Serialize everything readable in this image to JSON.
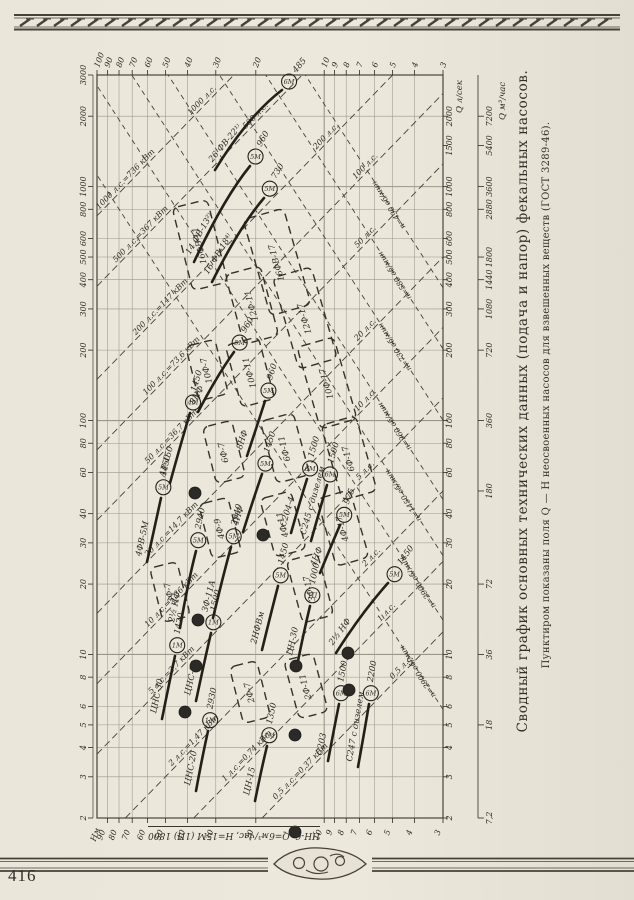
{
  "page": {
    "number": "416"
  },
  "caption": {
    "title": "Сводный график основных технических данных (подача и напор) фекальных насосов.",
    "subtitle": "Пунктиром показаны поля Q — Н неосвоенных насосов для взвешенных веществ (ГОСТ 3289-46)."
  },
  "annotation": {
    "full": "ЦН-6, Q=6м³/час, Н=15М (1П) 1800",
    "pump": "ЦН-6",
    "q": "6 м³/час",
    "h": "15 м",
    "motor": "1П",
    "rpm": "1800"
  },
  "chart_data": {
    "type": "line",
    "orientation": "chart is printed rotated 90° (rotate page clockwise to read); Q horizontal log axis, H vertical log axis",
    "grid": "log-log",
    "h_axis": {
      "label": "Нм",
      "unit": "м",
      "range": [
        3,
        100
      ],
      "ticks": [
        100,
        90,
        80,
        70,
        60,
        50,
        40,
        30,
        20,
        10,
        9,
        8,
        7,
        6,
        5,
        4,
        3
      ]
    },
    "q_axis_lsec": {
      "label": "Q л/сек",
      "range": [
        2,
        3000
      ],
      "ticks_left": [
        3000,
        2000,
        1000,
        800,
        600,
        500,
        400,
        300,
        200,
        100,
        80,
        60,
        40,
        30,
        20,
        10,
        8,
        6,
        5,
        4,
        3,
        2
      ],
      "ticks_right": [
        2000,
        1500,
        1000,
        800,
        600,
        500,
        400,
        300,
        200,
        100,
        80,
        60,
        40,
        30,
        20,
        10,
        8,
        6,
        5,
        4,
        3,
        2
      ]
    },
    "q_axis_m3h": {
      "label": "Q м³/час",
      "ticks": [
        {
          "t": "7200",
          "q": 2000
        },
        {
          "t": "5400",
          "q": 1500
        },
        {
          "t": "3600",
          "q": 1000
        },
        {
          "t": "2880",
          "q": 800
        },
        {
          "t": "1800",
          "q": 500
        },
        {
          "t": "1440",
          "q": 400
        },
        {
          "t": "1080",
          "q": 300
        },
        {
          "t": "720",
          "q": 200
        },
        {
          "t": "360",
          "q": 100
        },
        {
          "t": "180",
          "q": 50
        },
        {
          "t": "72",
          "q": 20
        },
        {
          "t": "36",
          "q": 10
        },
        {
          "t": "18",
          "q": 5
        },
        {
          "t": "7,2",
          "q": 2
        }
      ]
    },
    "power_lines": [
      {
        "hp": 1000,
        "full": "1000 л.с.=736 кВт",
        "short": "1000 л.с."
      },
      {
        "hp": 500,
        "full": "500 л.с.=367 кВт",
        "short": "500 л.с."
      },
      {
        "hp": 200,
        "full": "200 л.с.=147 кВт",
        "short": "200 л.с."
      },
      {
        "hp": 100,
        "full": "100 л.с.=73,6 кВт",
        "short": "100 л.с."
      },
      {
        "hp": 50,
        "full": "50 л.с.=36,7 кВт",
        "short": "50 л.с."
      },
      {
        "hp": 20,
        "full": "20 л.с.=14,7 кВт",
        "short": "20 л.с."
      },
      {
        "hp": 10,
        "full": "10 л.с.=7,36 кВт",
        "short": "10 л.с."
      },
      {
        "hp": 5,
        "full": "5 л.с.=3,7 кВт",
        "short": "5 л.с."
      },
      {
        "hp": 2,
        "full": "2 л.с.=1,47 кВт",
        "short": "2 л.с."
      },
      {
        "hp": 1,
        "full": "1 л.с.=0,74 кВт",
        "short": "1 л.с."
      },
      {
        "hp": 0.5,
        "full": "0,5 л.с.=0,37 кВт",
        "short": "0,5 л.с."
      }
    ],
    "speed_lines": [
      {
        "label": "n=490 об/мин",
        "q": 820,
        "h": 5.1
      },
      {
        "label": "n=580 об/мин",
        "q": 410,
        "h": 4.8
      },
      {
        "label": "n=730 об/мин",
        "q": 203,
        "h": 4.8
      },
      {
        "label": "n=960 об/мин",
        "q": 93,
        "h": 4.8
      },
      {
        "label": "n=1450 об/мин",
        "q": 47,
        "h": 4.4
      },
      {
        "label": "n=2900 об/мин",
        "q": 20,
        "h": 3.8
      },
      {
        "label": "n=2900 об/мин",
        "q": 8.3,
        "h": 3.8
      }
    ],
    "pump_curves": [
      {
        "label": "26 ФВ-22¹⁾",
        "motor": "6М",
        "rpm": "485",
        "pts": [
          [
            215,
            170
          ],
          [
            248,
            116
          ],
          [
            282,
            90
          ]
        ]
      },
      {
        "label": "14 ФВ-13²⁾",
        "motor": "5М",
        "rpm": "960",
        "pts": [
          [
            194,
            262
          ],
          [
            224,
            198
          ],
          [
            250,
            166
          ]
        ]
      },
      {
        "label": "16 ФВ-18⁴⁾",
        "motor": "5М",
        "rpm": "730",
        "pts": [
          [
            212,
            282
          ],
          [
            240,
            226
          ],
          [
            264,
            198
          ]
        ]
      },
      {
        "label": "8НФ",
        "motor": "5М",
        "rpm": "960",
        "pts": [
          [
            198,
            412
          ],
          [
            218,
            374
          ],
          [
            234,
            352
          ]
        ]
      },
      {
        "label": "8НФ",
        "motor": "5М",
        "rpm": "960",
        "pts": [
          [
            247,
            456
          ],
          [
            257,
            426
          ],
          [
            265,
            401
          ]
        ]
      },
      {
        "label": "АР-150",
        "motor": "4М",
        "rpm": "1450",
        "pts": [
          [
            170,
            483
          ],
          [
            181,
            443
          ],
          [
            190,
            413
          ]
        ]
      },
      {
        "label": "4ФВ-5М",
        "motor": "5М",
        "rpm": "1450",
        "pts": [
          [
            147,
            562
          ],
          [
            155,
            526
          ],
          [
            161,
            498
          ]
        ]
      },
      {
        "label": "2½ НФ",
        "motor": "5М",
        "rpm": "2940",
        "pts": [
          [
            180,
            628
          ],
          [
            188,
            582
          ],
          [
            196,
            551
          ]
        ]
      },
      {
        "label": "ЗФ-11А",
        "motor": "5М",
        "rpm": "2940",
        "pts": [
          [
            213,
            618
          ],
          [
            223,
            576
          ],
          [
            231,
            547
          ]
        ]
      },
      {
        "label": "4НФ",
        "motor": "5М",
        "rpm": "1450",
        "pts": [
          [
            243,
            532
          ],
          [
            254,
            497
          ],
          [
            262,
            474
          ]
        ]
      },
      {
        "label": "4НФ",
        "motor": "5М",
        "rpm": "975",
        "pts": [
          [
            320,
            573
          ],
          [
            331,
            546
          ],
          [
            340,
            525
          ]
        ]
      },
      {
        "label": "2НФВм",
        "motor": "5М",
        "rpm": "1450",
        "pts": [
          [
            262,
            650
          ],
          [
            271,
            613
          ],
          [
            278,
            586
          ]
        ]
      },
      {
        "label": "2½ НФ",
        "motor": "5М",
        "rpm": "1450",
        "pts": [
          [
            336,
            653
          ],
          [
            362,
            612
          ],
          [
            388,
            583
          ]
        ]
      },
      {
        "label": "С204-4",
        "motor": "6М",
        "rpm": "1500",
        "pts": [
          [
            291,
            533
          ],
          [
            300,
            501
          ],
          [
            307,
            479
          ]
        ]
      },
      {
        "label": "С245 с дизелем",
        "motor": "6М",
        "rpm": "1500",
        "pts": [
          [
            311,
            541
          ],
          [
            320,
            509
          ],
          [
            327,
            485
          ]
        ]
      },
      {
        "label": "ЦНС-50",
        "motor": "1М",
        "rpm": "1500",
        "pts": [
          [
            196,
            701
          ],
          [
            204,
            663
          ],
          [
            211,
            633
          ]
        ]
      },
      {
        "label": "ЦНС-30",
        "motor": "1М",
        "rpm": "1420",
        "pts": [
          [
            162,
            719
          ],
          [
            169,
            684
          ],
          [
            175,
            656
          ]
        ]
      },
      {
        "label": "ЦНС-20",
        "motor": "1М",
        "rpm": "2930",
        "pts": [
          [
            196,
            791
          ],
          [
            202,
            758
          ],
          [
            208,
            731
          ]
        ]
      },
      {
        "label": "ЦН-15",
        "motor": "1М",
        "rpm": "1350",
        "pts": [
          [
            255,
            801
          ],
          [
            261,
            771
          ],
          [
            267,
            746
          ]
        ]
      },
      {
        "label": "ЦН-30",
        "motor": "1П",
        "rpm": "1000",
        "pts": [
          [
            298,
            661
          ],
          [
            304,
            631
          ],
          [
            310,
            606
          ]
        ]
      },
      {
        "label": "С203",
        "motor": "6М",
        "rpm": "1500",
        "pts": [
          [
            328,
            761
          ],
          [
            334,
            729
          ],
          [
            339,
            704
          ]
        ]
      },
      {
        "label": "С247 с дизелем",
        "motor": "6М",
        "rpm": "2200",
        "pts": [
          [
            358,
            767
          ],
          [
            364,
            734
          ],
          [
            369,
            704
          ]
        ]
      }
    ],
    "pump_fields": [
      {
        "label": "16ФВ-11",
        "cx": 200,
        "cy": 245,
        "w": 36,
        "h": 85,
        "rot": -14
      },
      {
        "label": "16ФВ-17",
        "cx": 277,
        "cy": 262,
        "w": 42,
        "h": 100,
        "rot": -16
      },
      {
        "label": "12Ф-11",
        "cx": 252,
        "cy": 305,
        "w": 36,
        "h": 72,
        "rot": -15
      },
      {
        "label": "12Ф-17",
        "cx": 305,
        "cy": 318,
        "w": 40,
        "h": 95,
        "rot": -16
      },
      {
        "label": "10Ф-7",
        "cx": 207,
        "cy": 370,
        "w": 30,
        "h": 56,
        "rot": -14
      },
      {
        "label": "10Ф-11",
        "cx": 250,
        "cy": 372,
        "w": 34,
        "h": 64,
        "rot": -15
      },
      {
        "label": "10Ф-17",
        "cx": 327,
        "cy": 383,
        "w": 38,
        "h": 85,
        "rot": -16
      },
      {
        "label": "6Ф-7",
        "cx": 224,
        "cy": 452,
        "w": 30,
        "h": 58,
        "rot": -14
      },
      {
        "label": "6Ф-11",
        "cx": 285,
        "cy": 448,
        "w": 34,
        "h": 64,
        "rot": -15
      },
      {
        "label": "6Ф-17",
        "cx": 349,
        "cy": 458,
        "w": 36,
        "h": 78,
        "rot": -16
      },
      {
        "label": "4Ф-9",
        "cx": 220,
        "cy": 528,
        "w": 30,
        "h": 56,
        "rot": -14
      },
      {
        "label": "4Ф-11",
        "cx": 283,
        "cy": 524,
        "w": 32,
        "h": 60,
        "rot": -15
      },
      {
        "label": "4Ф-17",
        "cx": 343,
        "cy": 528,
        "w": 34,
        "h": 70,
        "rot": -16
      },
      {
        "label": "ЗФ-7",
        "cx": 170,
        "cy": 592,
        "w": 28,
        "h": 56,
        "rot": -14
      },
      {
        "label": "ЗФ-17",
        "cx": 310,
        "cy": 588,
        "w": 32,
        "h": 64,
        "rot": -15
      },
      {
        "label": "2Ф-7",
        "cx": 250,
        "cy": 692,
        "w": 28,
        "h": 58,
        "rot": -14
      },
      {
        "label": "2Ф-11",
        "cx": 306,
        "cy": 686,
        "w": 30,
        "h": 60,
        "rot": -15
      }
    ],
    "dots": [
      [
        195,
        493
      ],
      [
        263,
        535
      ],
      [
        198,
        620
      ],
      [
        196,
        666
      ],
      [
        185,
        712
      ],
      [
        296,
        666
      ],
      [
        348,
        653
      ],
      [
        349,
        690
      ],
      [
        295,
        735
      ],
      [
        295,
        832
      ]
    ]
  }
}
